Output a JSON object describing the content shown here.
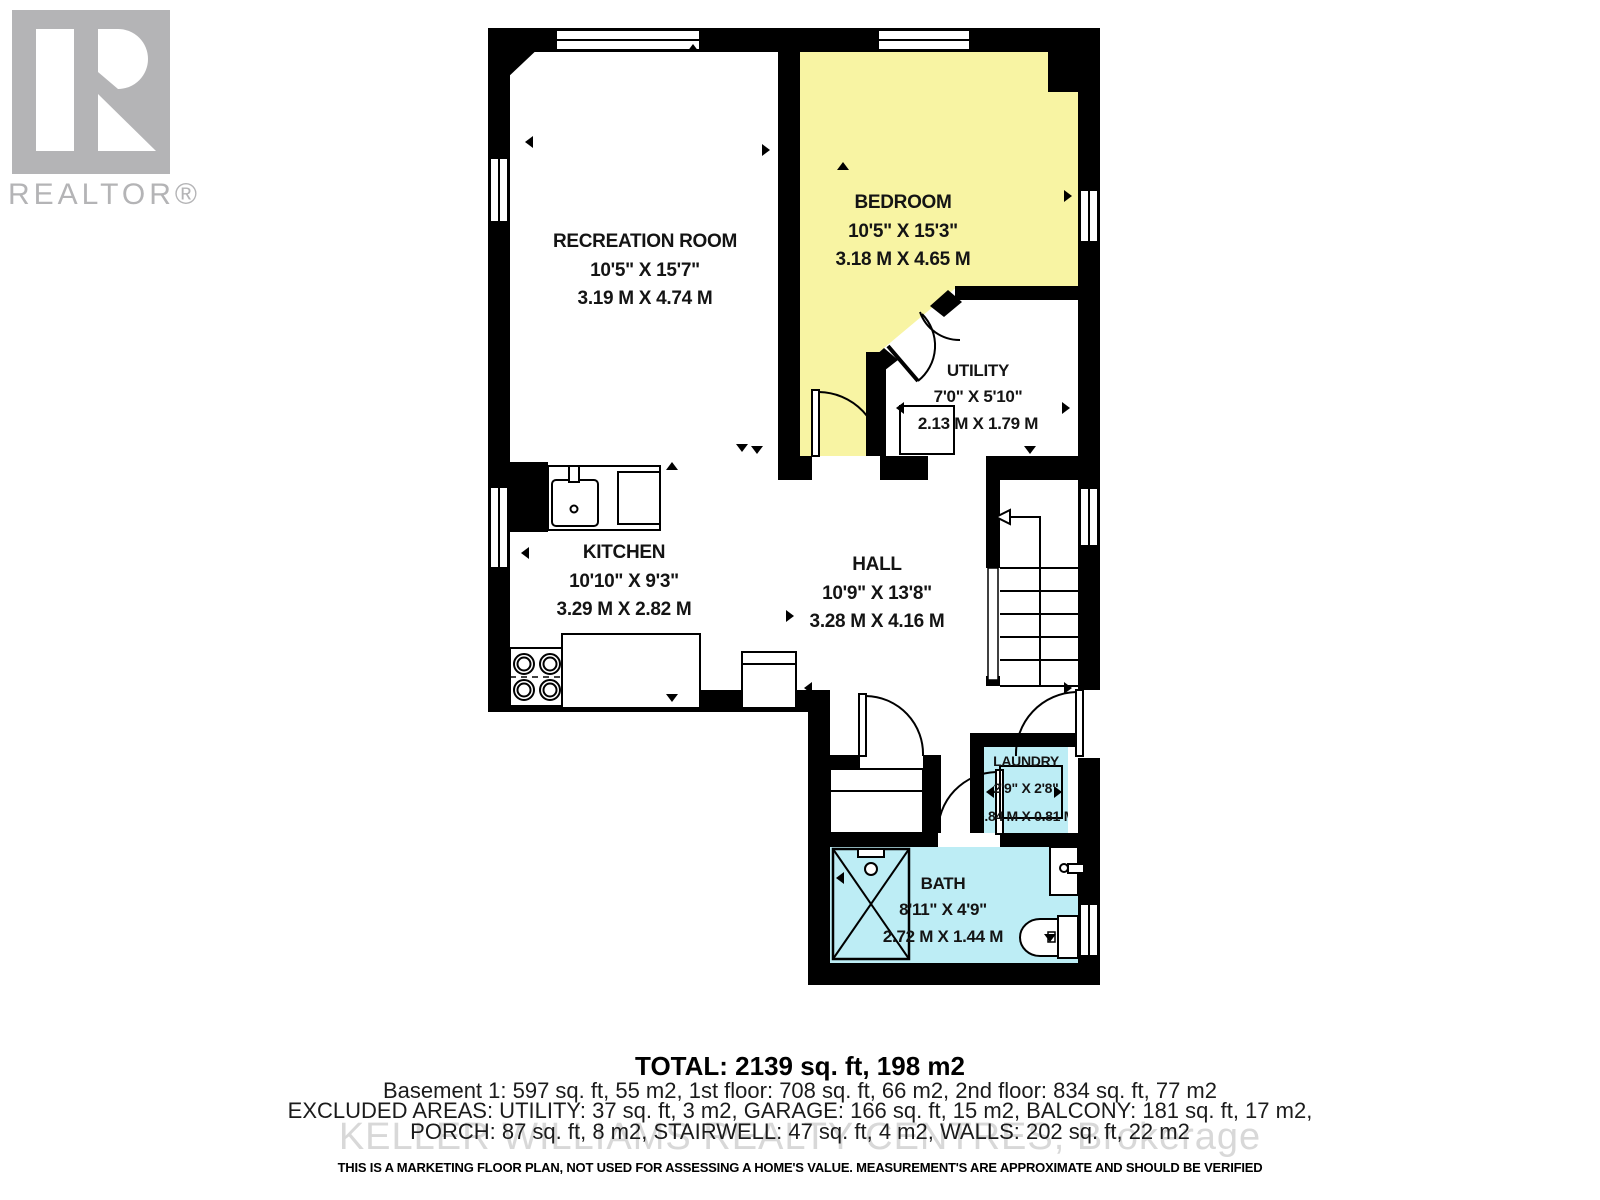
{
  "branding": {
    "logo_text": "REALTOR®"
  },
  "watermark": "KELLER WILLIAMS REALTY CENTRES, Brokerage",
  "rooms": {
    "recreation": {
      "name": "RECREATION ROOM",
      "imperial": "10'5\" X 15'7\"",
      "metric": "3.19 M X 4.74 M"
    },
    "bedroom": {
      "name": "BEDROOM",
      "imperial": "10'5\" X 15'3\"",
      "metric": "3.18 M X 4.65 M"
    },
    "utility": {
      "name": "UTILITY",
      "imperial": "7'0\" X 5'10\"",
      "metric": "2.13 M X 1.79 M"
    },
    "kitchen": {
      "name": "KITCHEN",
      "imperial": "10'10\" X 9'3\"",
      "metric": "3.29 M X 2.82 M"
    },
    "hall": {
      "name": "HALL",
      "imperial": "10'9\" X 13'8\"",
      "metric": "3.28 M X 4.16 M"
    },
    "laundry": {
      "name": "LAUNDRY",
      "imperial": "2'9\" X 2'8\"",
      "metric": "0.84 M X 0.81 M"
    },
    "bath": {
      "name": "BATH",
      "imperial": "8'11\" X 4'9\"",
      "metric": "2.72 M X 1.44 M"
    }
  },
  "summary": {
    "total": "TOTAL: 2139 sq. ft, 198 m2",
    "floors": "Basement 1: 597 sq. ft, 55 m2, 1st floor: 708 sq. ft, 66 m2, 2nd floor: 834 sq. ft, 77 m2",
    "excluded_line1": "EXCLUDED AREAS: UTILITY: 37 sq. ft, 3 m2, GARAGE: 166 sq. ft, 15 m2, BALCONY: 181 sq. ft, 17 m2,",
    "excluded_line2": "PORCH: 87 sq. ft, 8 m2, STAIRWELL: 47 sq. ft, 4 m2, WALLS: 202 sq. ft, 22 m2",
    "disclaimer": "THIS IS A MARKETING FLOOR PLAN, NOT USED FOR ASSESSING A HOME'S VALUE. MEASUREMENT'S ARE APPROXIMATE AND SHOULD BE VERIFIED"
  },
  "colors": {
    "bedroom_fill": "#f8f4a3",
    "bath_fill": "#bdedf5",
    "wall": "#000000",
    "logo_gray": "#b4b4b6",
    "watermark_gray": "#d8d8d8"
  }
}
